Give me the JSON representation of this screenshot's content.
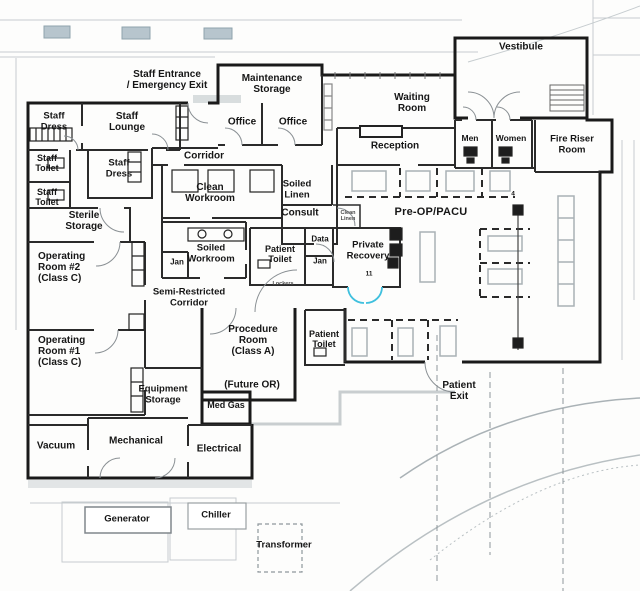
{
  "colors": {
    "wall": "#1a1a1a",
    "interior_wall": "#2b2b2b",
    "door_arc": "#8a9094",
    "recovery_door_blue": "#3fc0de",
    "site_line": "#c2c9cc",
    "site_fill": "#b7c5cd",
    "fixture_light": "#a9b1b5"
  },
  "rooms": {
    "vestibule": "Vestibule",
    "waiting_room": "Waiting\nRoom",
    "maintenance_storage": "Maintenance\nStorage",
    "office_1": "Office",
    "office_2": "Office",
    "reception": "Reception",
    "men": "Men",
    "women": "Women",
    "fire_riser": "Fire Riser\nRoom",
    "pre_op": "Pre-OP/PACU",
    "corridor": "Corridor",
    "staff_dress_1": "Staff\nDress",
    "staff_lounge": "Staff\nLounge",
    "staff_toilet_1": "Staff\nToilet",
    "staff_toilet_2": "Staff\nToilet",
    "staff_dress_2": "Staff\nDress",
    "sterile_storage": "Sterile\nStorage",
    "clean_workroom": "Clean\nWorkroom",
    "soiled_linen": "Soiled\nLinen",
    "consult": "Consult",
    "soiled_workroom": "Soiled\nWorkroom",
    "jan_left": "Jan",
    "patient_toilet_upper": "Patient\nToilet",
    "data": "Data",
    "jan_right": "Jan",
    "private_recovery": "Private\nRecovery",
    "semi_restricted": "Semi-Restricted\nCorridor",
    "operating_room_2": "Operating\nRoom #2\n(Class C)",
    "operating_room_1": "Operating\nRoom #1\n(Class C)",
    "procedure_room": "Procedure\nRoom\n(Class A)",
    "future_or": "(Future OR)",
    "patient_toilet_lower": "Patient\nToilet",
    "equipment_storage": "Equipment\nStorage",
    "med_gas": "Med Gas",
    "vacuum": "Vacuum",
    "mechanical": "Mechanical",
    "electrical": "Electrical"
  },
  "site": {
    "staff_entrance": "Staff Entrance\n/ Emergency Exit",
    "patient_exit": "Patient\nExit",
    "generator": "Generator",
    "chiller": "Chiller",
    "transformer": "Transformer"
  },
  "tiny": {
    "clean_linen": "Clean\nLinen",
    "lockers": "Lockers",
    "bay_4": "4",
    "recovery_11": "11"
  }
}
